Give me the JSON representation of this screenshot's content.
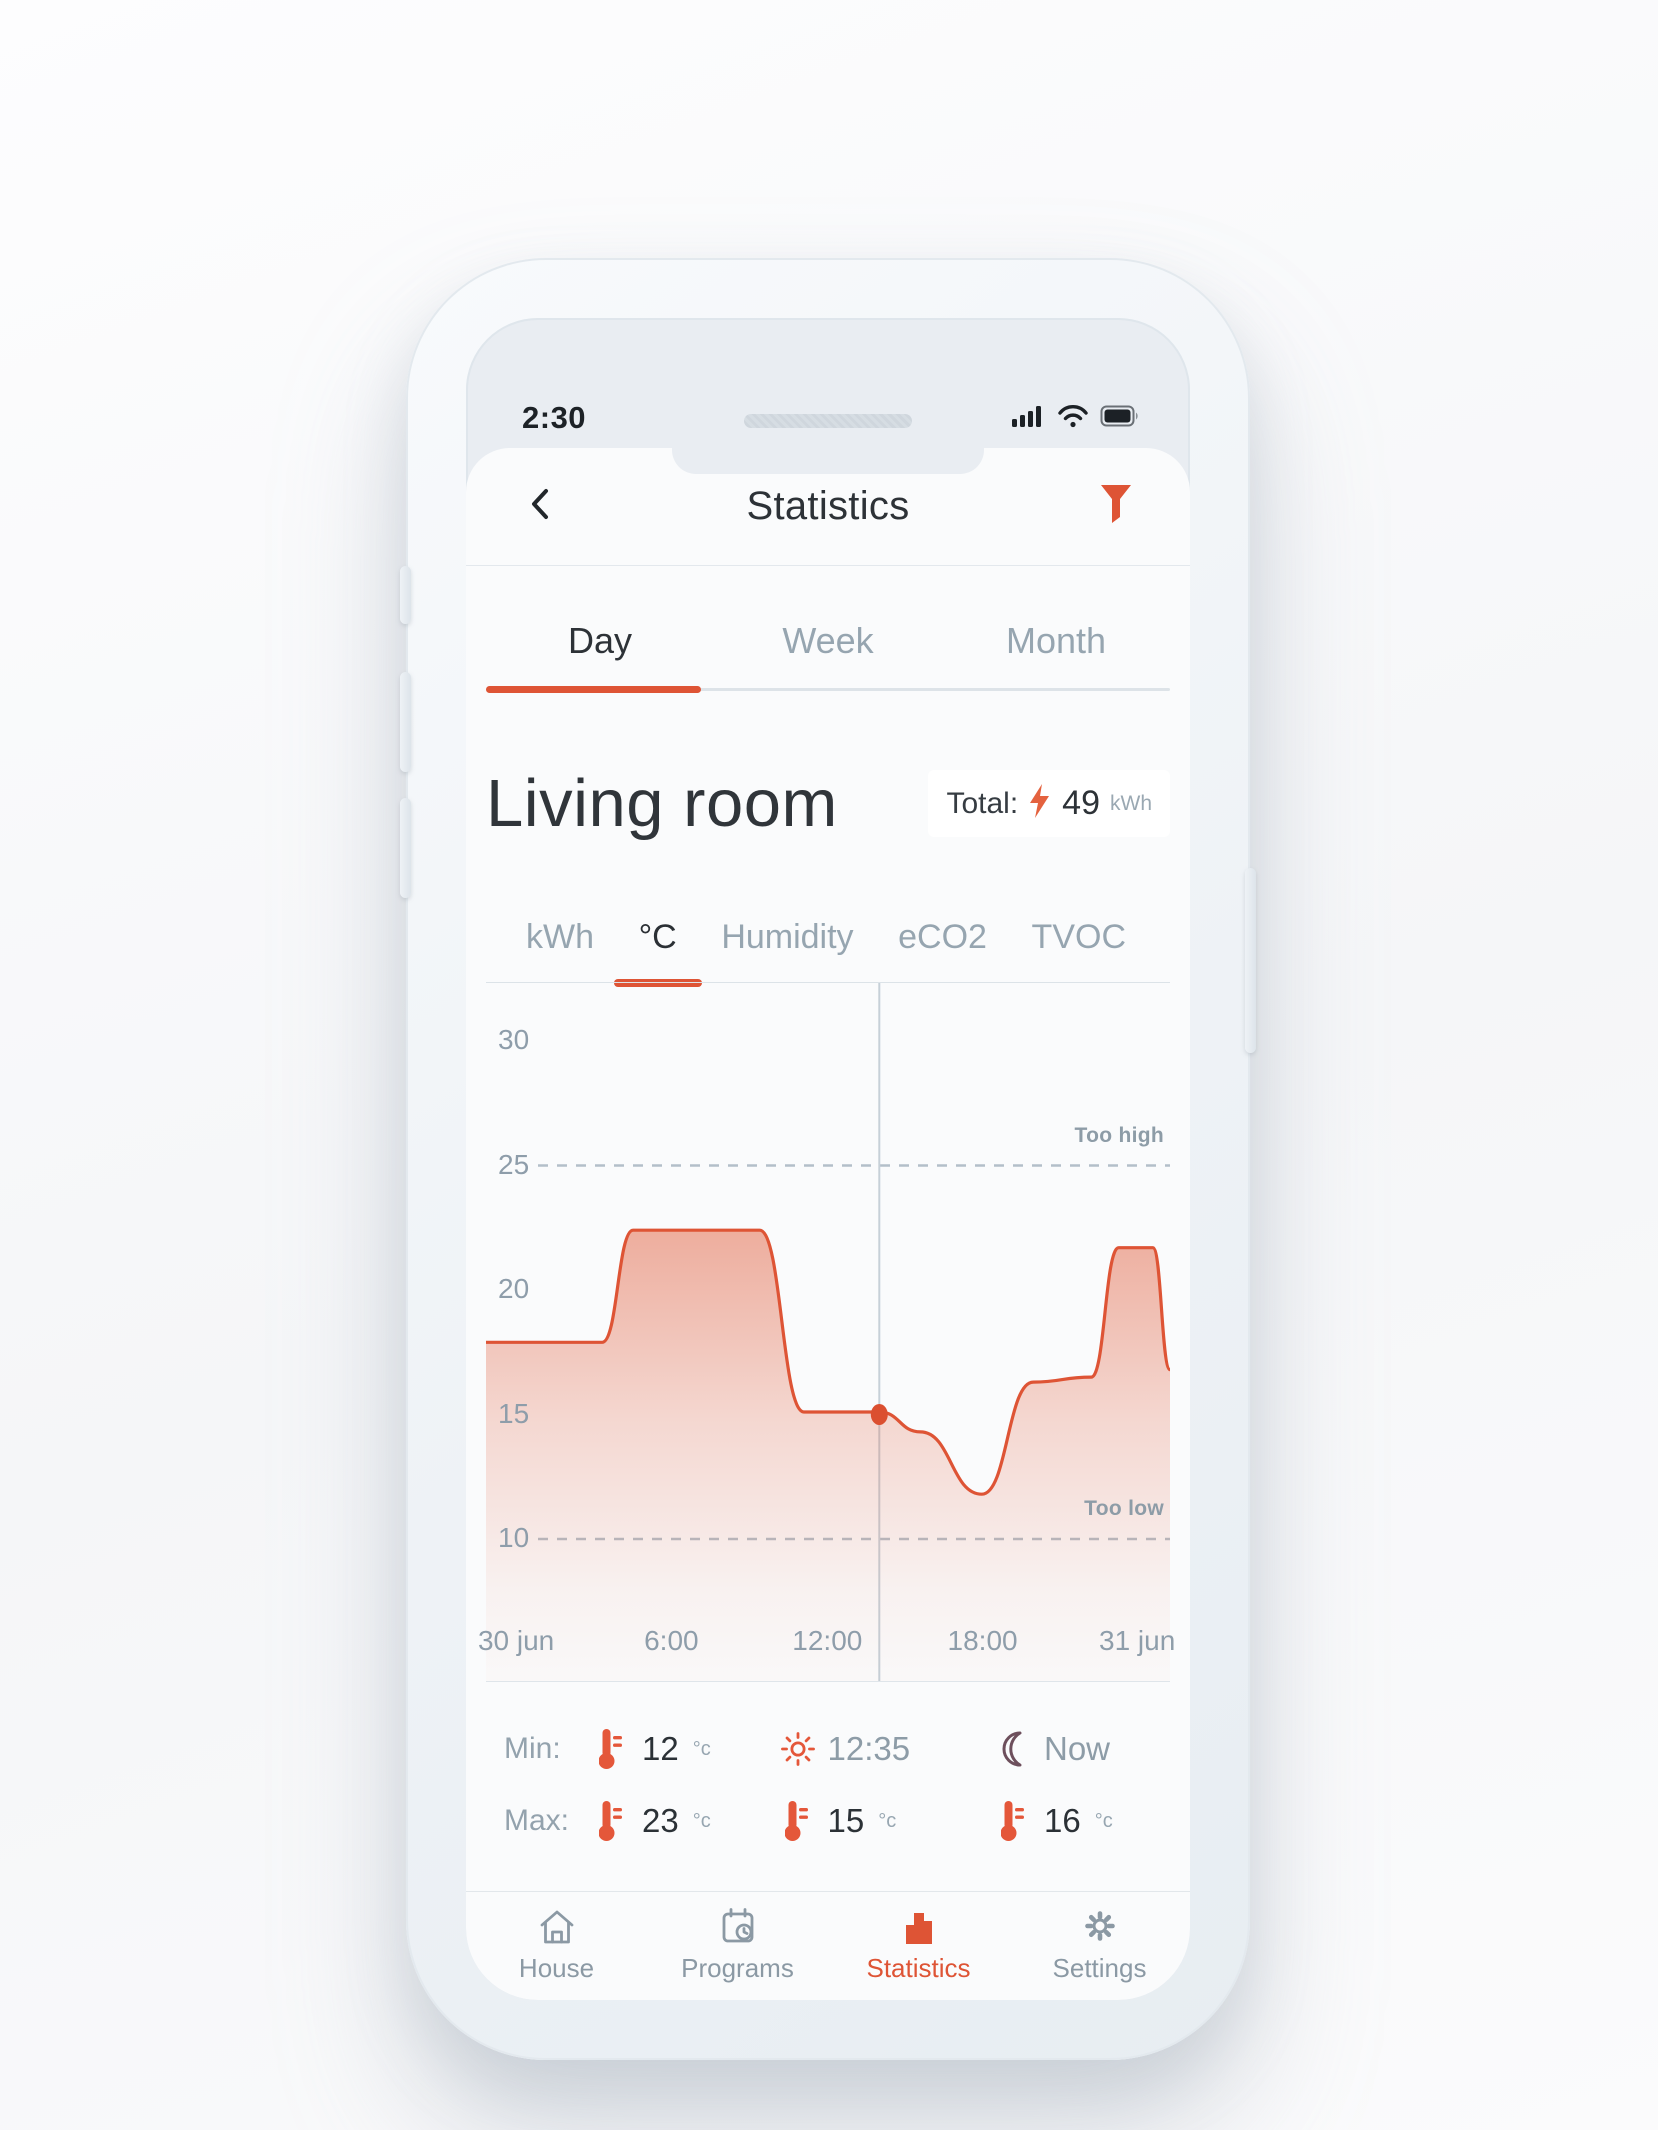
{
  "colors": {
    "accent": "#DE5435",
    "dark_text": "#2D3237",
    "gray_text": "#96A5B0",
    "moon": "#6D4F5C",
    "chart_fill_top": "#E05A38"
  },
  "status_bar": {
    "time": "2:30",
    "icons": [
      "cellular-signal",
      "wifi",
      "battery-full"
    ]
  },
  "header": {
    "title": "Statistics"
  },
  "period_tabs": {
    "items": [
      {
        "label": "Day",
        "active": true
      },
      {
        "label": "Week",
        "active": false
      },
      {
        "label": "Month",
        "active": false
      }
    ]
  },
  "room": {
    "name": "Living room",
    "total": {
      "label": "Total:",
      "value": "49",
      "unit": "kWh"
    }
  },
  "metric_tabs": {
    "items": [
      {
        "label": "kWh",
        "active": false
      },
      {
        "label": "°C",
        "active": true
      },
      {
        "label": "Humidity",
        "active": false
      },
      {
        "label": "eCO2",
        "active": false
      },
      {
        "label": "TVOC",
        "active": false
      }
    ]
  },
  "chart_data": {
    "type": "area",
    "title": "Living room temperature — Day view",
    "ylabel": "°C",
    "ylim": [
      7.3,
      32.3
    ],
    "yticks": [
      30,
      25,
      20,
      15,
      10
    ],
    "xticks": [
      "30 jun",
      "6:00",
      "12:00",
      "18:00",
      "31 jun"
    ],
    "grid": false,
    "legend": "none",
    "thresholds": {
      "high": {
        "value": 25,
        "label": "Too high"
      },
      "low": {
        "value": 10,
        "label": "Too low"
      }
    },
    "cursor": {
      "x_fraction": 0.575,
      "time": "12:35",
      "value": 15
    },
    "series": [
      {
        "name": "temperature_c",
        "points": [
          [
            0.0,
            17.9
          ],
          [
            0.17,
            17.9
          ],
          [
            0.215,
            22.4
          ],
          [
            0.4,
            22.4
          ],
          [
            0.465,
            15.1
          ],
          [
            0.575,
            15.1
          ],
          [
            0.635,
            14.3
          ],
          [
            0.725,
            11.8
          ],
          [
            0.8,
            16.3
          ],
          [
            0.885,
            16.5
          ],
          [
            0.925,
            21.7
          ],
          [
            0.975,
            21.7
          ],
          [
            1.0,
            16.8
          ]
        ]
      }
    ]
  },
  "stats": {
    "min_label": "Min:",
    "max_label": "Max:",
    "min": {
      "value": "12",
      "unit": "°c"
    },
    "max": {
      "value": "23",
      "unit": "°c"
    },
    "midday": {
      "time": "12:35",
      "value": "15",
      "unit": "°c"
    },
    "now": {
      "label": "Now",
      "value": "16",
      "unit": "°c"
    }
  },
  "nav": {
    "items": [
      {
        "label": "House",
        "active": false
      },
      {
        "label": "Programs",
        "active": false
      },
      {
        "label": "Statistics",
        "active": true
      },
      {
        "label": "Settings",
        "active": false
      }
    ]
  }
}
